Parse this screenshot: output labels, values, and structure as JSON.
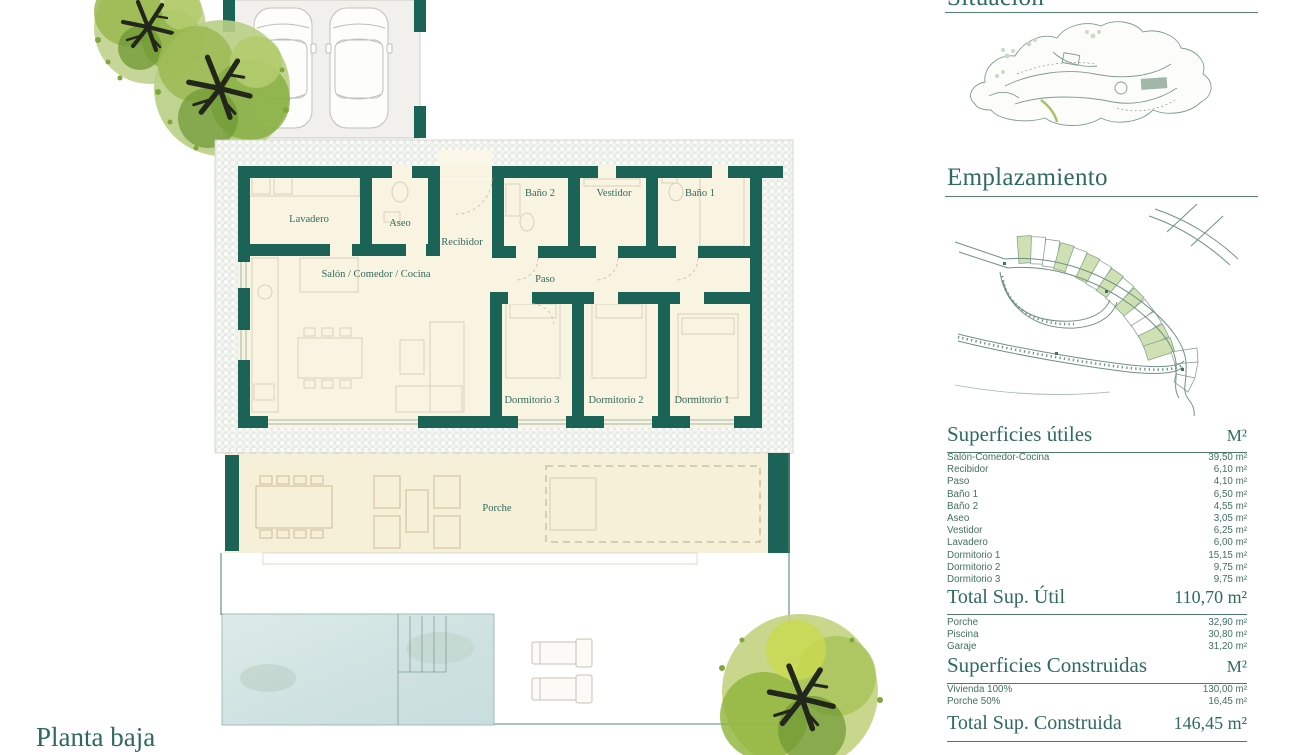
{
  "page": {
    "plan_title": "Planta baja"
  },
  "plan": {
    "rooms": [
      {
        "label": "Lavadero"
      },
      {
        "label": "Aseo"
      },
      {
        "label": "Recibidor"
      },
      {
        "label": "Baño 2"
      },
      {
        "label": "Vestidor"
      },
      {
        "label": "Baño 1"
      },
      {
        "label": "Salón / Comedor / Cocina"
      },
      {
        "label": "Paso"
      },
      {
        "label": "Dormitorio 3"
      },
      {
        "label": "Dormitorio 2"
      },
      {
        "label": "Dormitorio 1"
      },
      {
        "label": "Porche"
      }
    ]
  },
  "sidebar": {
    "situacion_title": "Situación",
    "emplazamiento_title": "Emplazamiento",
    "tables": {
      "utiles": {
        "title": "Superficies útiles",
        "unit_header": "M²",
        "rows": [
          {
            "label": "Salón-Comedor-Cocina",
            "value": "39,50 m²"
          },
          {
            "label": "Recibidor",
            "value": "6,10 m²"
          },
          {
            "label": "Paso",
            "value": "4,10 m²"
          },
          {
            "label": "Baño 1",
            "value": "6,50 m²"
          },
          {
            "label": "Baño 2",
            "value": "4,55 m²"
          },
          {
            "label": "Aseo",
            "value": "3,05 m²"
          },
          {
            "label": "Vestidor",
            "value": "6,25 m²"
          },
          {
            "label": "Lavadero",
            "value": "6,00 m²"
          },
          {
            "label": "Dormitorio 1",
            "value": "15,15 m²"
          },
          {
            "label": "Dormitorio 2",
            "value": "9,75 m²"
          },
          {
            "label": "Dormitorio 3",
            "value": "9,75 m²"
          }
        ],
        "total_label": "Total Sup. Útil",
        "total_value": "110,70 m²"
      },
      "extras": {
        "rows": [
          {
            "label": "Porche",
            "value": "32,90 m²"
          },
          {
            "label": "Piscina",
            "value": "30,80 m²"
          },
          {
            "label": "Garaje",
            "value": "31,20 m²"
          }
        ]
      },
      "construidas": {
        "title": "Superficies Construidas",
        "unit_header": "M²",
        "rows": [
          {
            "label": "Vivienda 100%",
            "value": "130,00 m²"
          },
          {
            "label": "Porche 50%",
            "value": "16,45 m²"
          }
        ],
        "total_label": "Total Sup. Construida",
        "total_value": "146,45 m²"
      }
    }
  },
  "colors": {
    "wall_teal": "#1a6356",
    "text_teal": "#2e6b5c",
    "interior_cream": "#f9f4e2",
    "porch_cream": "#f7f0d9",
    "plot_green": "#cfe0b2",
    "pool_blue": "#d3e5e3"
  }
}
